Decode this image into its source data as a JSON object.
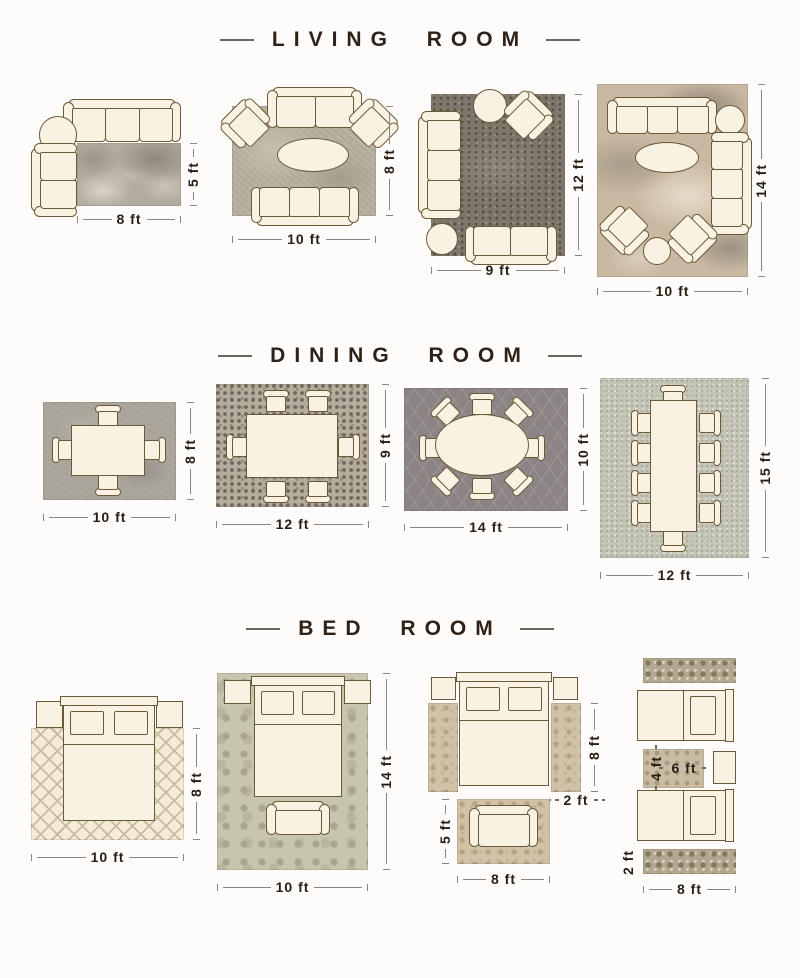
{
  "page_title": "Rug size guide by room",
  "colors": {
    "background": "#fdfcfa",
    "furniture_fill": "#f8f2e2",
    "furniture_outline": "#6d5839",
    "title_text": "#2e2118",
    "dimension_text": "#281d12",
    "dimension_line": "#8b8780"
  },
  "sections": [
    {
      "title": "LIVING ROOM",
      "diagrams": [
        {
          "labels": {
            "width": "8 ft",
            "height": "5 ft"
          }
        },
        {
          "labels": {
            "width": "10 ft",
            "height": "8 ft"
          }
        },
        {
          "labels": {
            "width": "9 ft",
            "height": "12 ft"
          }
        },
        {
          "labels": {
            "width": "10 ft",
            "height": "14 ft"
          }
        }
      ]
    },
    {
      "title": "DINING ROOM",
      "diagrams": [
        {
          "labels": {
            "width": "10 ft",
            "height": "8 ft"
          }
        },
        {
          "labels": {
            "width": "12 ft",
            "height": "9 ft"
          }
        },
        {
          "labels": {
            "width": "14 ft",
            "height": "10 ft"
          }
        },
        {
          "labels": {
            "width": "12 ft",
            "height": "15 ft"
          }
        }
      ]
    },
    {
      "title": "BED ROOM",
      "diagrams": [
        {
          "labels": {
            "width": "10 ft",
            "height": "8 ft"
          }
        },
        {
          "labels": {
            "width": "10 ft",
            "height": "14 ft"
          }
        },
        {
          "labels": {
            "side_runner_length": "8 ft",
            "runner_width": "2 ft",
            "foot_rug_height": "5 ft",
            "foot_rug_width": "8 ft"
          }
        },
        {
          "labels": {
            "accent_rug_height": "4 ft",
            "accent_rug_width": "6 ft",
            "runner_height": "2 ft",
            "runner_length": "8 ft"
          }
        }
      ]
    }
  ]
}
